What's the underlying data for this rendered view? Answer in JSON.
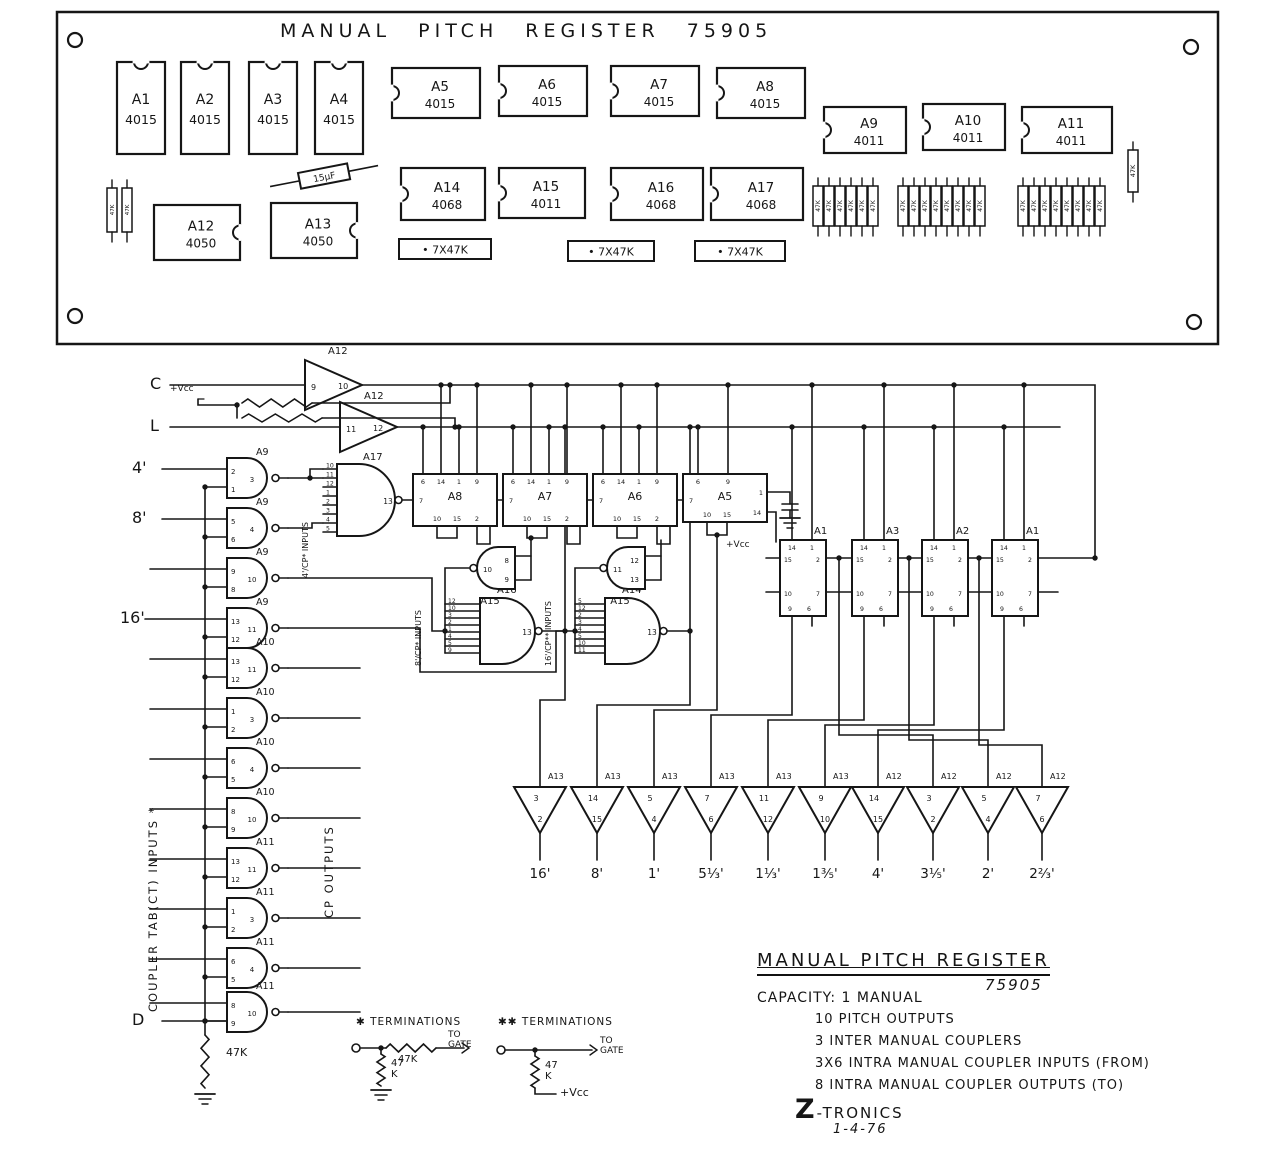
{
  "board": {
    "title": "MANUAL PITCH REGISTER 75905",
    "ics_vertical": [
      {
        "name": "A1",
        "part": "4015"
      },
      {
        "name": "A2",
        "part": "4015"
      },
      {
        "name": "A3",
        "part": "4015"
      },
      {
        "name": "A4",
        "part": "4015"
      }
    ],
    "ics_row2": [
      {
        "name": "A5",
        "part": "4015"
      },
      {
        "name": "A6",
        "part": "4015"
      },
      {
        "name": "A7",
        "part": "4015"
      },
      {
        "name": "A8",
        "part": "4015"
      }
    ],
    "ics_row3": [
      {
        "name": "A9",
        "part": "4011"
      },
      {
        "name": "A10",
        "part": "4011"
      },
      {
        "name": "A11",
        "part": "4011"
      }
    ],
    "ics_row4": [
      {
        "name": "A12",
        "part": "4050"
      },
      {
        "name": "A13",
        "part": "4050"
      }
    ],
    "ics_row5": [
      {
        "name": "A14",
        "part": "4068"
      },
      {
        "name": "A15",
        "part": "4011"
      },
      {
        "name": "A16",
        "part": "4068"
      },
      {
        "name": "A17",
        "part": "4068"
      }
    ],
    "cap_label": "15µF",
    "res_pack_labels": [
      "• 7X47K",
      "• 7X47K",
      "• 7X47K"
    ],
    "res_bank_label": "47K",
    "corner_res_label": "47K"
  },
  "schematic": {
    "inputs": {
      "c": "C",
      "l": "L",
      "p4": "4'",
      "p8": "8'",
      "p16": "16'",
      "d": "D"
    },
    "vcc": "+Vcc",
    "res47k": "47K",
    "input_buffers": [
      {
        "chip": "A12",
        "pin_in": "9",
        "pin_out": "10"
      },
      {
        "chip": "A12",
        "pin_in": "11",
        "pin_out": "12"
      }
    ],
    "gates": [
      {
        "chip": "A9",
        "a": "2",
        "b": "1",
        "out": "3"
      },
      {
        "chip": "A9",
        "a": "5",
        "b": "6",
        "out": "4"
      },
      {
        "chip": "A9",
        "a": "9",
        "b": "8",
        "out": "10"
      },
      {
        "chip": "A9",
        "a": "13",
        "b": "12",
        "out": "11"
      },
      {
        "chip": "A10",
        "a": "13",
        "b": "12",
        "out": "11"
      },
      {
        "chip": "A10",
        "a": "1",
        "b": "2",
        "out": "3"
      },
      {
        "chip": "A10",
        "a": "6",
        "b": "5",
        "out": "4"
      },
      {
        "chip": "A10",
        "a": "8",
        "b": "9",
        "out": "10"
      },
      {
        "chip": "A11",
        "a": "13",
        "b": "12",
        "out": "11"
      },
      {
        "chip": "A11",
        "a": "1",
        "b": "2",
        "out": "3"
      },
      {
        "chip": "A11",
        "a": "6",
        "b": "5",
        "out": "4"
      },
      {
        "chip": "A11",
        "a": "8",
        "b": "9",
        "out": "10"
      }
    ],
    "gate17": {
      "name": "A17",
      "pins": [
        "10",
        "11",
        "12",
        "1",
        "2",
        "3",
        "4",
        "5"
      ],
      "out": "13"
    },
    "gate16": {
      "name": "A16",
      "pins": [
        "12",
        "10",
        "3",
        "2",
        "1",
        "4",
        "5",
        "9"
      ],
      "out": "13"
    },
    "gate14": {
      "name": "A14",
      "pins": [
        "5",
        "12",
        "2",
        "3",
        "4",
        "5",
        "10",
        "11"
      ],
      "out": "13"
    },
    "nand15": [
      {
        "name": "A15",
        "out": "10",
        "ina": "8",
        "inb": "9"
      },
      {
        "name": "A15",
        "out": "11",
        "ina": "12",
        "inb": "13"
      }
    ],
    "chips": [
      {
        "name": "A8",
        "top": [
          "6",
          "14",
          "1",
          "9"
        ],
        "left": "7",
        "bottom": [
          "10",
          "15",
          "2"
        ]
      },
      {
        "name": "A7",
        "top": [
          "6",
          "14",
          "1",
          "9"
        ],
        "left": "7",
        "bottom": [
          "10",
          "15",
          "2"
        ]
      },
      {
        "name": "A6",
        "top": [
          "6",
          "14",
          "1",
          "9"
        ],
        "left": "7",
        "bottom": [
          "10",
          "15",
          "2"
        ]
      },
      {
        "name": "A5",
        "top": [
          "6",
          "9"
        ],
        "left": "7",
        "bottom": [
          "10",
          "15"
        ],
        "right": [
          "1",
          "14"
        ]
      }
    ],
    "right_chips": [
      {
        "name": "A1"
      },
      {
        "name": "A3"
      },
      {
        "name": "A2"
      },
      {
        "name": "A1"
      }
    ],
    "right_chip_pins": {
      "top": [
        "14",
        "1"
      ],
      "row1": [
        "15",
        "2"
      ],
      "row2": [
        "10",
        "7"
      ],
      "bottom": [
        "9",
        "6"
      ]
    },
    "buffers": [
      {
        "chip": "A13",
        "pin_in": "3",
        "pin_out": "2",
        "label": "16'"
      },
      {
        "chip": "A13",
        "pin_in": "14",
        "pin_out": "15",
        "label": "8'"
      },
      {
        "chip": "A13",
        "pin_in": "5",
        "pin_out": "4",
        "label": "1'"
      },
      {
        "chip": "A13",
        "pin_in": "7",
        "pin_out": "6",
        "label": "5⅓'"
      },
      {
        "chip": "A13",
        "pin_in": "11",
        "pin_out": "12",
        "label": "1⅓'"
      },
      {
        "chip": "A13",
        "pin_in": "9",
        "pin_out": "10",
        "label": "1⅗'"
      },
      {
        "chip": "A12",
        "pin_in": "14",
        "pin_out": "15",
        "label": "4'"
      },
      {
        "chip": "A12",
        "pin_in": "3",
        "pin_out": "2",
        "label": "3⅕'"
      },
      {
        "chip": "A12",
        "pin_in": "5",
        "pin_out": "4",
        "label": "2'"
      },
      {
        "chip": "A12",
        "pin_in": "7",
        "pin_out": "6",
        "label": "2⅔'"
      }
    ],
    "notes": {
      "coupler": "COUPLER TAB(CT) INPUTS *",
      "cp_out": "CP OUTPUTS",
      "in4": "4'/CP* INPUTS",
      "in8": "8'/CP* INPUTS",
      "in16": "16'/CP** INPUTS"
    }
  },
  "terminations": [
    {
      "title": "✱ TERMINATIONS",
      "series": "47K",
      "shunt": "47 K",
      "dest": "TO GATE"
    },
    {
      "title": "✱✱ TERMINATIONS",
      "shunt": "47 K",
      "dest": "TO GATE",
      "sink": "+Vcc"
    }
  ],
  "legend": {
    "title": "MANUAL PITCH REGISTER",
    "part": "75905",
    "capacity": "CAPACITY: 1 MANUAL",
    "items": [
      "10 PITCH OUTPUTS",
      "3 INTER MANUAL COUPLERS",
      "3X6 INTRA MANUAL COUPLER INPUTS (FROM)",
      "8 INTRA MANUAL COUPLER OUTPUTS (TO)"
    ],
    "brand": "Z-TRONICS",
    "date": "1-4-76"
  }
}
